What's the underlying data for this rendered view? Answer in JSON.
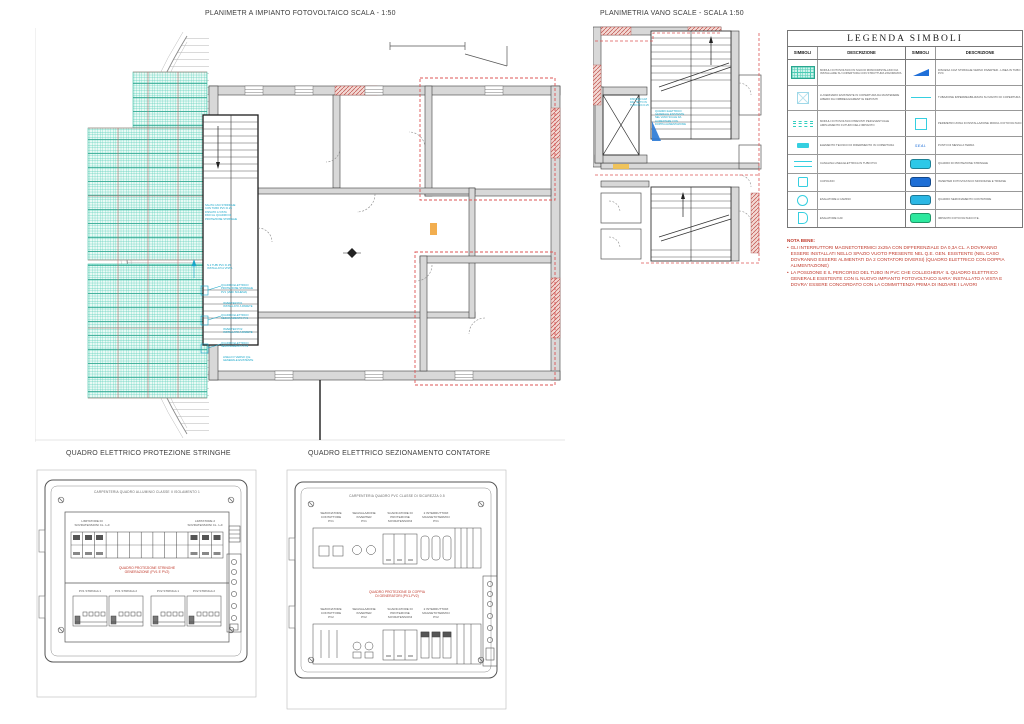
{
  "titles": {
    "pv_plan": "PLANIMETR A IMPIANTO FOTOVOLTAICO SCALA - 1:50",
    "stairs_plan": "PLANIMETRIA VANO SCALE - SCALA 1:50",
    "panel1": "QUADRO ELETTRICO PROTEZIONE STRINGHE",
    "panel2": "QUADRO ELETTRICO SEZIONAMENTO CONTATORE"
  },
  "legend": {
    "title": "LEGENDA  SIMBOLI",
    "col_symbol": "SIMBOLI",
    "col_desc": "DESCRIZIONE",
    "seal_label": "SEAL",
    "left_rows": [
      "MODULI FOTOVOLTAICI IN SILICIO MONOCRISTALLINO DA INSTALLARE SU COPERTURA CON STRUTTURA ZAVORRATA",
      "LUCERNARIO ESISTENTE IN COPERTURA DA MANTENERE LIBERO DA OMBREGGIAMENTI E DEPOSITI",
      "MODULI FOTOVOLTAICI PREVISTI PER EVENTUALE AMPLIAMENTO FUTURO DELL'IMPIANTO",
      "ELEMENTO TECNICO DI RIFERIMENTO IN COPERTURA",
      "CANALINA LINEA ELETTRICA IN TUBO PVC",
      "CUPOLINO",
      "ESALATORE A CAMINO",
      "ESALATORE CAF"
    ],
    "right_rows": [
      "DISCESA CAVI STRINGHE VERSO INVERTER - LINEA IN TUBO PVC",
      "TUBAZIONE IMPERMEABILIZZATA SU MANTO DI COPERTURA",
      "PERIMETRO ZONA DI INSTALLAZIONE MODULI FOTOVOLTAICI",
      "PUNTO DI MESSA A TERRA",
      "QUADRO DI PROTEZIONE STRINGHE",
      "INVERTER FOTOVOLTAICO MONOFASE E TRIFASE",
      "QUADRO SEZIONAMENTO CONTATORE",
      "IMPIANTO FOTOVOLTAICO P.E."
    ]
  },
  "note": {
    "heading": "NOTA BENE:",
    "bullets": [
      "GLI INTERRUTTORI MAGNETOTERMICI 2x25A CON DIFFERENZIALE DA 0,3A CL. A DOVRANNO ESSERE INSTALLATI NELLO SPAZIO VUOTO PRESENTE NEL Q.E. GEN. ESISTENTE (NEL CASO DOVRANNO ESSERE ALIMENTATI DA 2 CONTATORI DIVERSI) (QUADRO ELETTRICO CON DOPPIA ALIMENTAZIONE)",
      "LA POSIZIONE E IL PERCORSO DEL TUBO IN PVC CHE COLLEGHERA' IL QUADRO ELETTRICO GENERALE ESISTENTE CON IL NUOVO IMPIANTO FOTOVOLTAICO SARA' INSTALLATO A VISTA E DOVRA' ESSERE CONCORDATO CON LA COMMITTENZA PRIMA DI INIZIARE I LAVORI"
    ]
  },
  "pv_plan": {
    "annotations": [
      "SALITA CAVI STRINGHE\nCON TUBO PVC D.25\nFISSATO A VISTA\nFINO AL QUADRO DI\nPROTEZIONE STRINGHE",
      "N.2 TUBI PVC D.25\nINSTALLATI A VISTA",
      "QUADRO ELETTRICO\nPROTEZIONE STRINGHE\nPV1 (VEDI SCHEMA)",
      "INVERTER PV1\nINSTALLATO A PARETE",
      "QUADRO ELETTRICO\nSEZIONAMENTO PV1",
      "INVERTER PV2\nINSTALLATO A PARETE",
      "QUADRO ELETTRICO\nSEZIONAMENTO PV2",
      "LINEA FV VERSO Q.E.\nGENERALE ESISTENTE"
    ]
  },
  "stairs": {
    "annotations": [
      "DISCESA CAVI\nDAL TETTO IN\nTUBO PVC D.25",
      "QUADRO ELETTRICO\nGENERALE ESISTENTE\nNEL VANO SCALE DA\nALIMENTARE CON\nDOPPIA ALIMENTAZIONE"
    ]
  },
  "panel1": {
    "header": "CARPENTERIA QUADRO ALLUMINIO CLASSE II ISOLAMENTO 1",
    "label_left": "LIMITATORE DI\nSOVRATENSIONI CL. I+II",
    "label_right": "LIMITATORE 2\nSOVRATENSIONI CL. I+II",
    "red_text": "QUADRO PROTEZIONE STRINGHE\nGENERAZIONE (PV1 E PV2)",
    "groups": [
      "PV1 STRINGA 1",
      "PV1 STRINGA 2",
      "PV2 STRINGA 1",
      "PV2 STRINGA 2"
    ]
  },
  "panel2": {
    "header": "CARPENTERIA QUADRO PVC CLASSE DI SICUREZZA 0.5",
    "top_labels": [
      "SEZIONATORE\nCONTATTORE\nPV1",
      "SEGNALAZIONE\nINVERTER\nPV1",
      "SCARICATORE DI\nPROTEZIONE\nSOVRATENSIONI",
      "2 INTERRUTTORI\nMAGNETOTERMICI\nPV1"
    ],
    "bottom_labels": [
      "SEZIONATORE\nCONTATTORE\nPV2",
      "SEGNALAZIONE\nINVERTER\nPV2",
      "SCARICATORE DI\nPROTEZIONE\nSOVRATENSIONI",
      "2 INTERRUTTORI\nMAGNETOTERMICI\nPV2"
    ],
    "red_text": "QUADRO PROTEZIONE DI COPPIA\nDI GENERATORI (PV1-PV2)"
  },
  "colors": {
    "pv_teal": "#4ccbb4",
    "annotation_cyan": "#17a6c9",
    "dashed_red": "#dd5555",
    "brick_red": "#c0504d",
    "note_red": "#c0392b",
    "chip_cyan": "#2cc8e8",
    "chip_blue": "#1e6fd6",
    "chip_green": "#2de89e",
    "wall_gray": "#d8d8d8"
  }
}
